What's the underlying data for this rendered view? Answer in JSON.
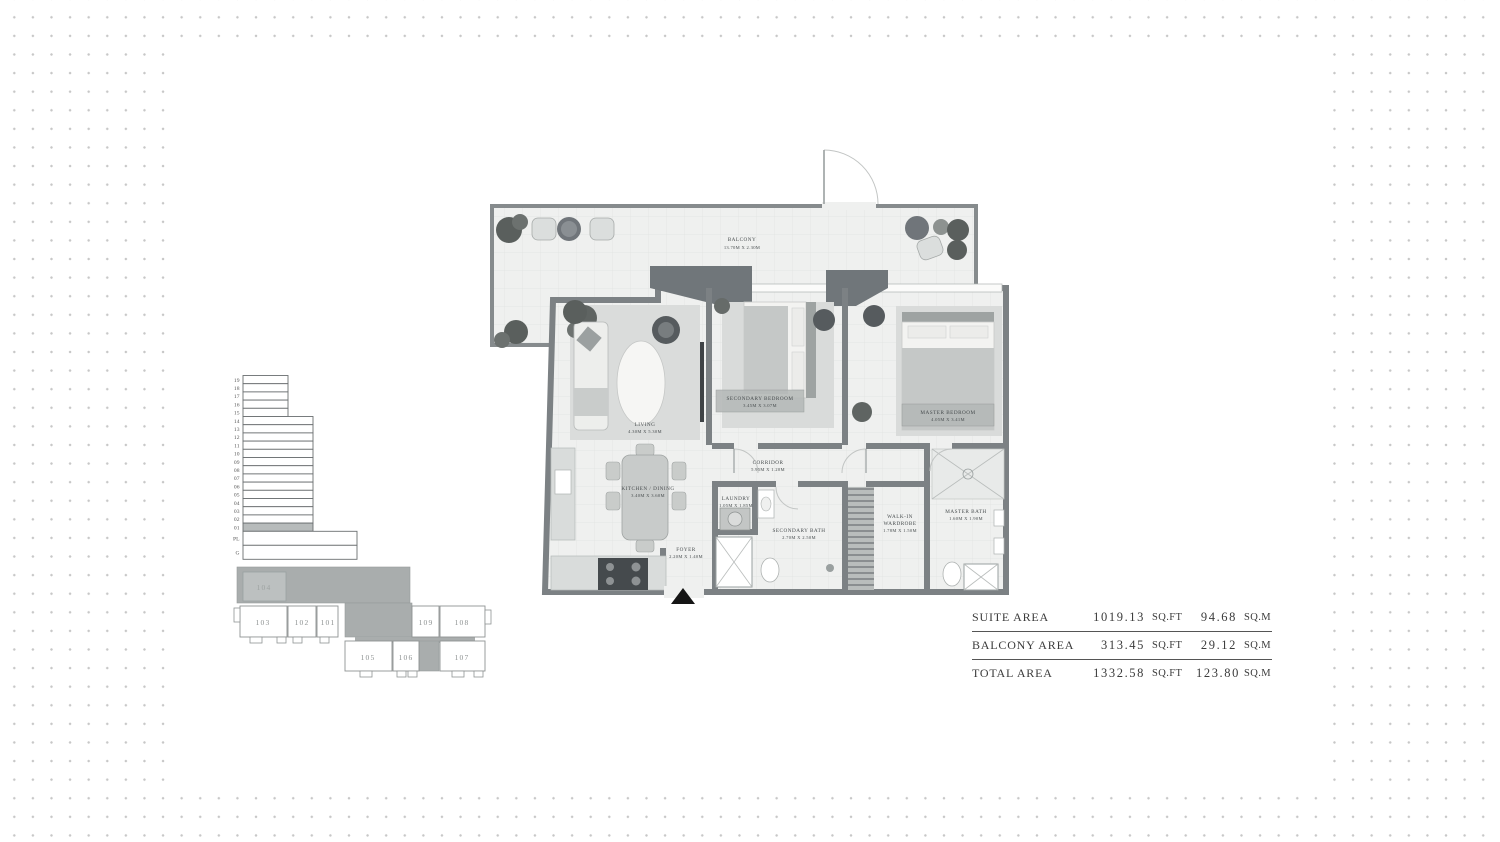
{
  "colors": {
    "wall": "#7c8184",
    "floor": "#eff0ef",
    "dot": "#c7c7c7"
  },
  "floor_plan": {
    "rooms": [
      {
        "label": "BALCONY",
        "dims": "13.70M X 2.30M"
      },
      {
        "label": "LIVING",
        "dims": "4.30M X 5.30M"
      },
      {
        "label": "SECONDARY BEDROOM",
        "dims": "3.45M X 3.07M"
      },
      {
        "label": "MASTER BEDROOM",
        "dims": "4.05M X 3.41M"
      },
      {
        "label": "CORRIDOR",
        "dims": "5.95M X 1.20M"
      },
      {
        "label": "KITCHEN / DINING",
        "dims": "3.40M X 3.60M"
      },
      {
        "label": "FOYER",
        "dims": "2.20M X 1.40M"
      },
      {
        "label": "LAUNDRY",
        "dims": "1.05M X 1.85M"
      },
      {
        "label": "SECONDARY BATH",
        "dims": "2.70M X 2.50M"
      },
      {
        "label": "WALK-IN WARDROBE",
        "label_lines": [
          "WALK-IN",
          "WARDROBE"
        ],
        "dims": "1.78M X 1.50M"
      },
      {
        "label": "MASTER BATH",
        "dims": "1.60M X 1.90M"
      }
    ]
  },
  "building_key": {
    "floors": [
      "19",
      "18",
      "17",
      "16",
      "15",
      "14",
      "13",
      "12",
      "11",
      "10",
      "09",
      "08",
      "07",
      "06",
      "05",
      "04",
      "03",
      "02",
      "01",
      "PL",
      "G"
    ],
    "highlighted_floor": "01",
    "highlight_fill": "#b7bbbb"
  },
  "unit_key": {
    "units": [
      "104",
      "103",
      "102",
      "101",
      "109",
      "108",
      "105",
      "106",
      "107"
    ],
    "highlighted_unit": "104",
    "highlight_fill": "#bcc0c0"
  },
  "area_table": {
    "rows": [
      {
        "label": "SUITE AREA",
        "sqft": "1019.13",
        "sqft_unit": "SQ.FT",
        "sqm": "94.68",
        "sqm_unit": "SQ.M"
      },
      {
        "label": "BALCONY AREA",
        "sqft": "313.45",
        "sqft_unit": "SQ.FT",
        "sqm": "29.12",
        "sqm_unit": "SQ.M"
      },
      {
        "label": "TOTAL AREA",
        "sqft": "1332.58",
        "sqft_unit": "SQ.FT",
        "sqm": "123.80",
        "sqm_unit": "SQ.M"
      }
    ]
  }
}
